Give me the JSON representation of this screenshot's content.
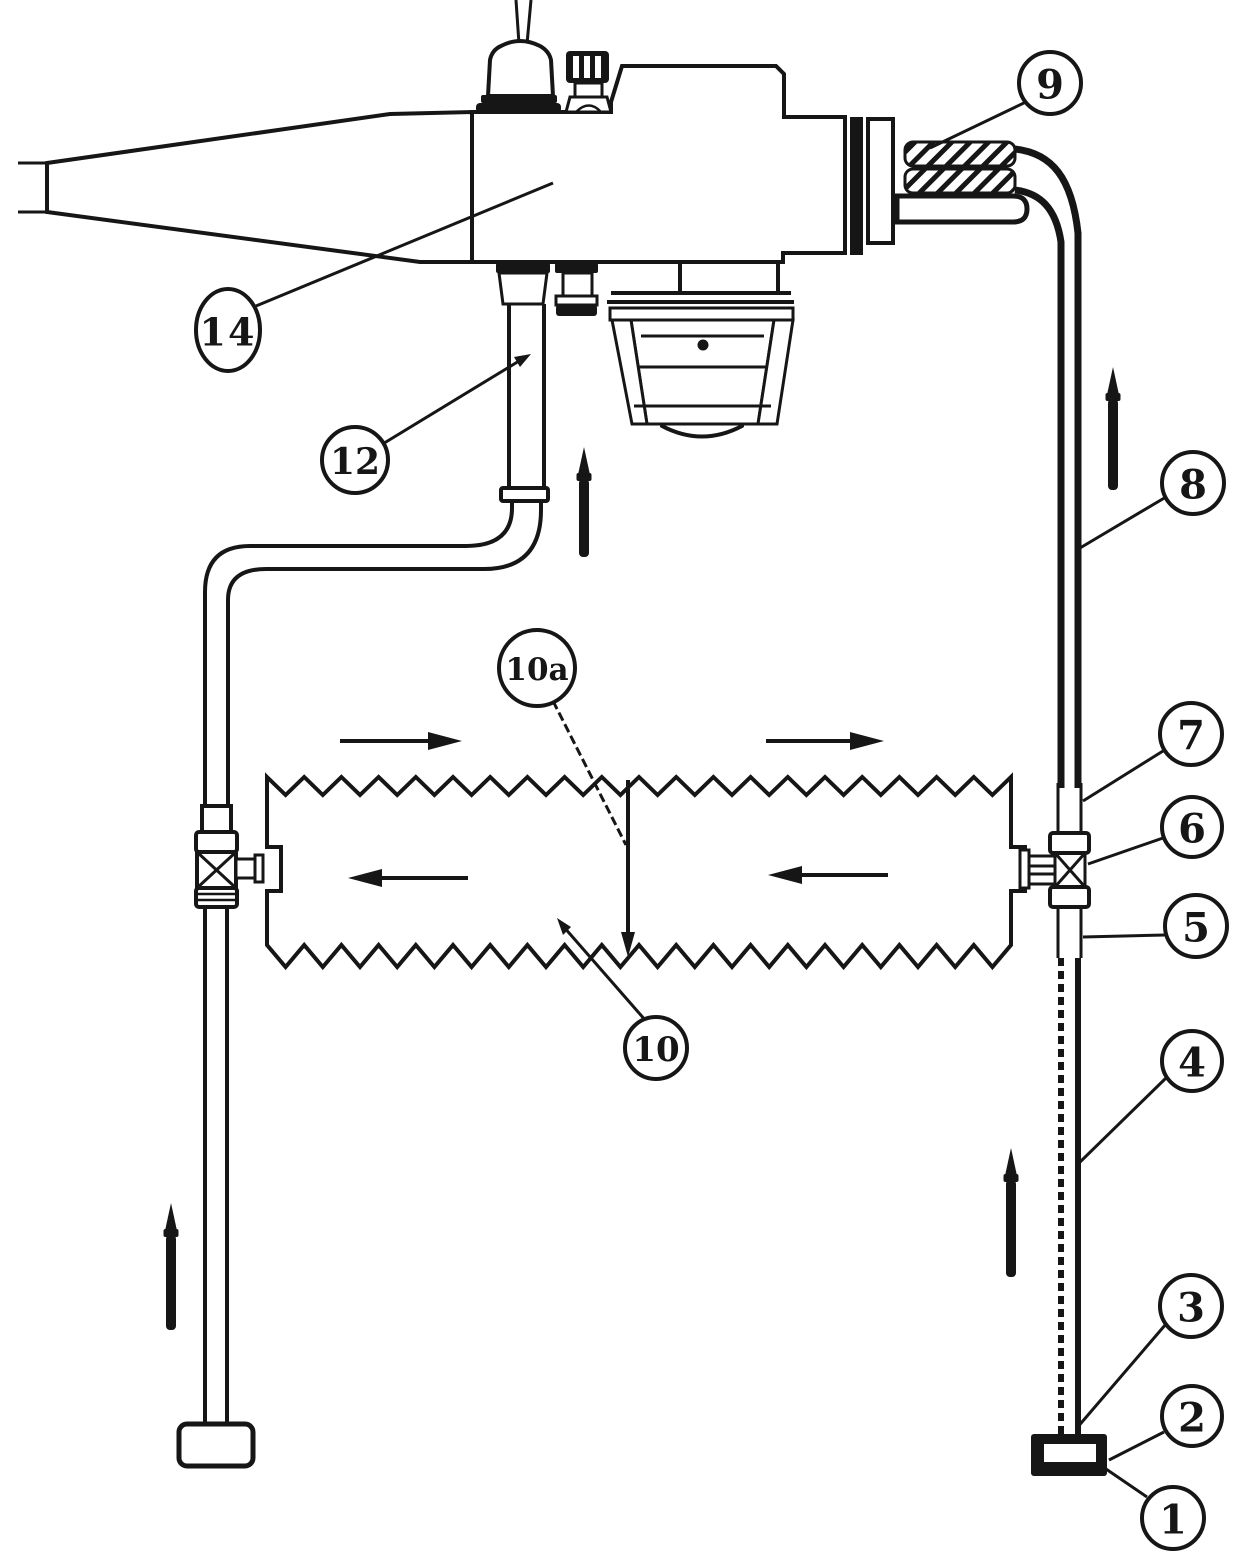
{
  "figure": {
    "background_color": "#ffffff",
    "ink_color": "#161616",
    "type": "patent-line-drawing",
    "callouts": {
      "c1": "1",
      "c2": "2",
      "c3": "3",
      "c4": "4",
      "c5": "5",
      "c6": "6",
      "c7": "7",
      "c8": "8",
      "c9": "9",
      "c10": "10",
      "c10a": "10a",
      "c12": "12",
      "c14": "14"
    }
  }
}
